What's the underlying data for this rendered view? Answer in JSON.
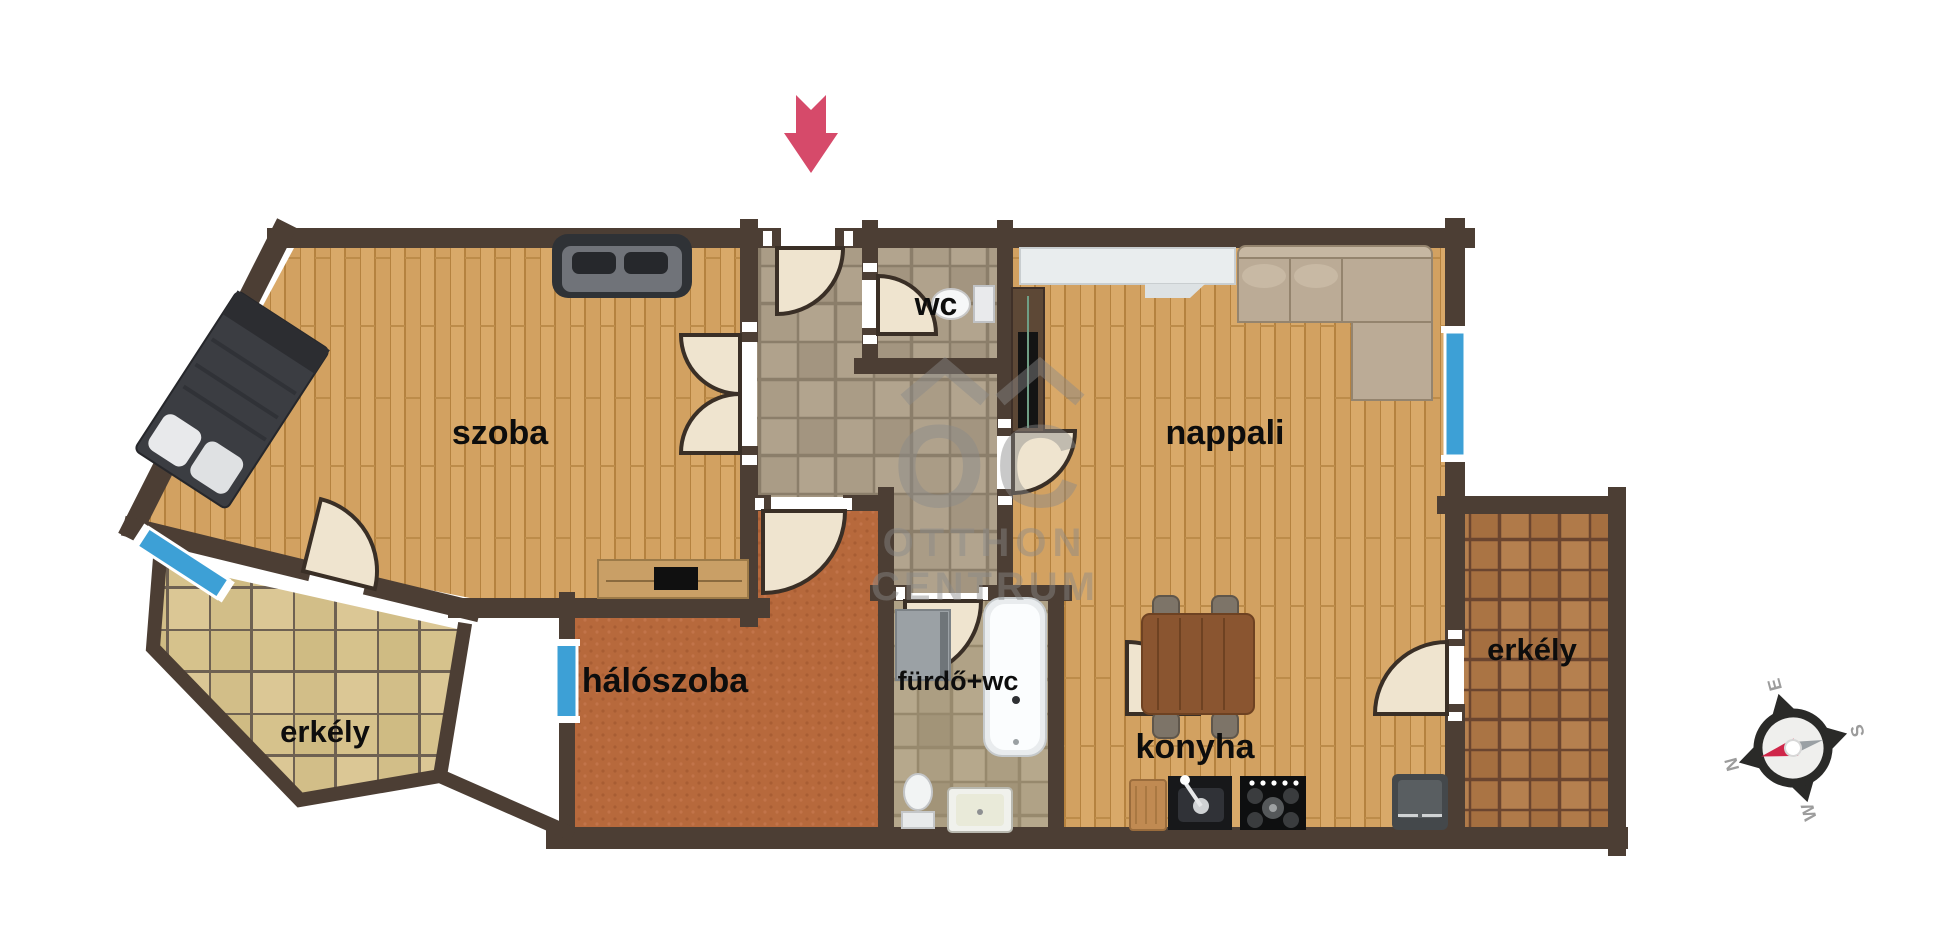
{
  "plan": {
    "labels": {
      "room": "szoba",
      "living": "nappali",
      "bedroom": "hálószoba",
      "wc": "wc",
      "bathroom": "fürdő+wc",
      "kitchen": "konyha",
      "balcony_left": "erkély",
      "balcony_right": "erkély"
    },
    "watermark": {
      "logo": "OC",
      "line1": "OTTHON",
      "line2": "CENTRUM"
    },
    "compass": {
      "n": "N",
      "e": "E",
      "s": "S",
      "w": "W"
    },
    "colors": {
      "wall": "#4c3e34",
      "arrow": "#d64a6a",
      "window": "#3da0d6",
      "wood_floor": "#d9a969",
      "hall_tile": "#aa9c86",
      "bedroom_carpet": "#b7693c",
      "balcony_left_tile": "#dbc795",
      "balcony_right_tile": "#b5804f",
      "door_leaf": "#efe4cf"
    }
  }
}
